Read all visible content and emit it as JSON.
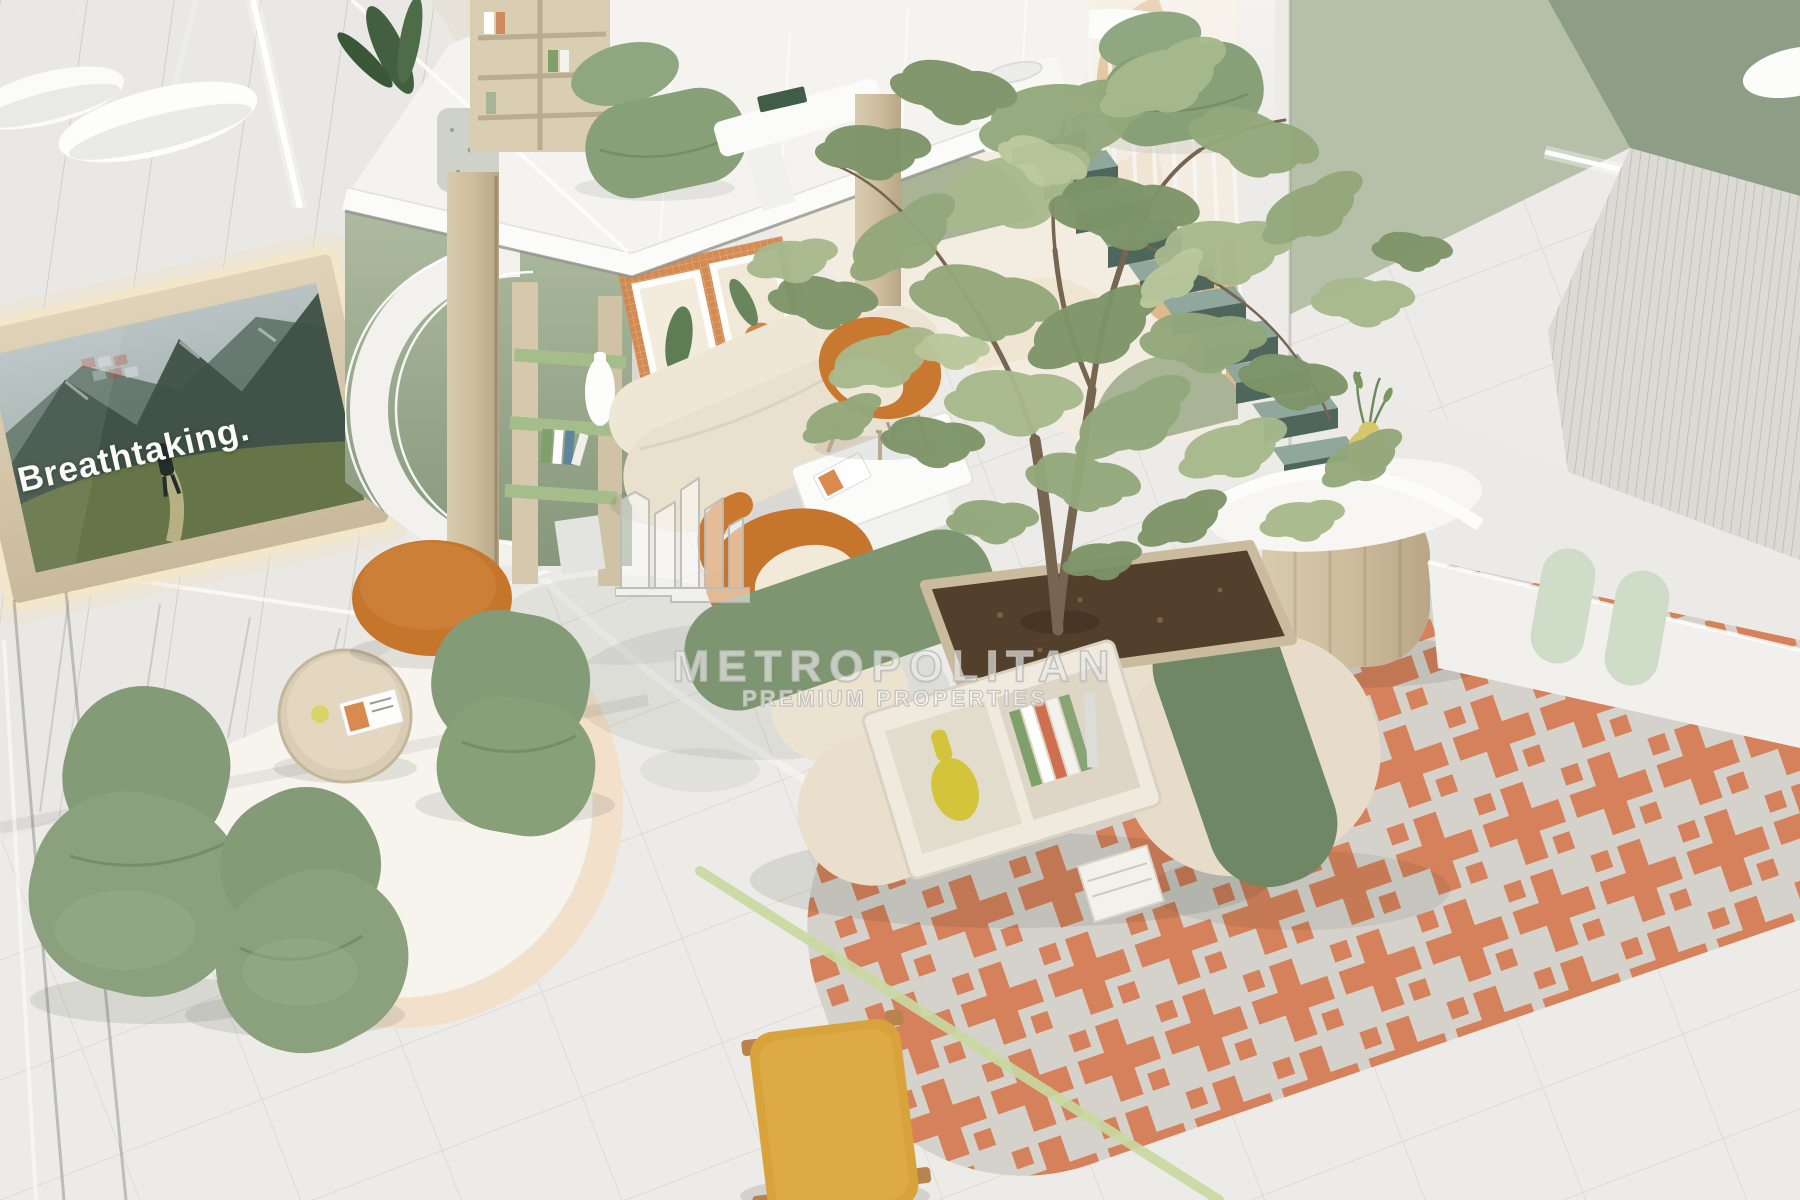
{
  "image": {
    "kind": "3d-interior-render",
    "subject": "aerial view of a pastel residential lobby lounge with mezzanine, floating stairs, indoor olive tree and reception desk"
  },
  "tv": {
    "caption": "Breathtaking."
  },
  "watermark": {
    "brand": "METROPOLITAN",
    "tagline": "PREMIUM PROPERTIES",
    "logo": "metropolitan-skyline-logo"
  },
  "palette": {
    "floor": "#ecebe7",
    "wall_white": "#e9e8e4",
    "wood": "#d3c5a8",
    "sage_wall": "#9fae92",
    "pattern_tan": "#ddb98b",
    "pattern_sage": "#a9b497",
    "pattern_cream": "#f3ede1",
    "furniture_green": "#87a078",
    "cushion_green": "#7d9570",
    "cushion_green_dark": "#6f8764",
    "orange": "#c5762c",
    "terracotta_rug": "#d5815b",
    "rug_base": "#d4d2cb",
    "cream_sofa": "#e9e0cd",
    "step_teal": "#4f665d",
    "step_top": "#8fa79d",
    "soil": "#52402c",
    "accent_stripe": "#c9d9a0",
    "mustard": "#d9a33c",
    "vase_yellow": "#d4c43c",
    "led_white": "#ffffff"
  }
}
